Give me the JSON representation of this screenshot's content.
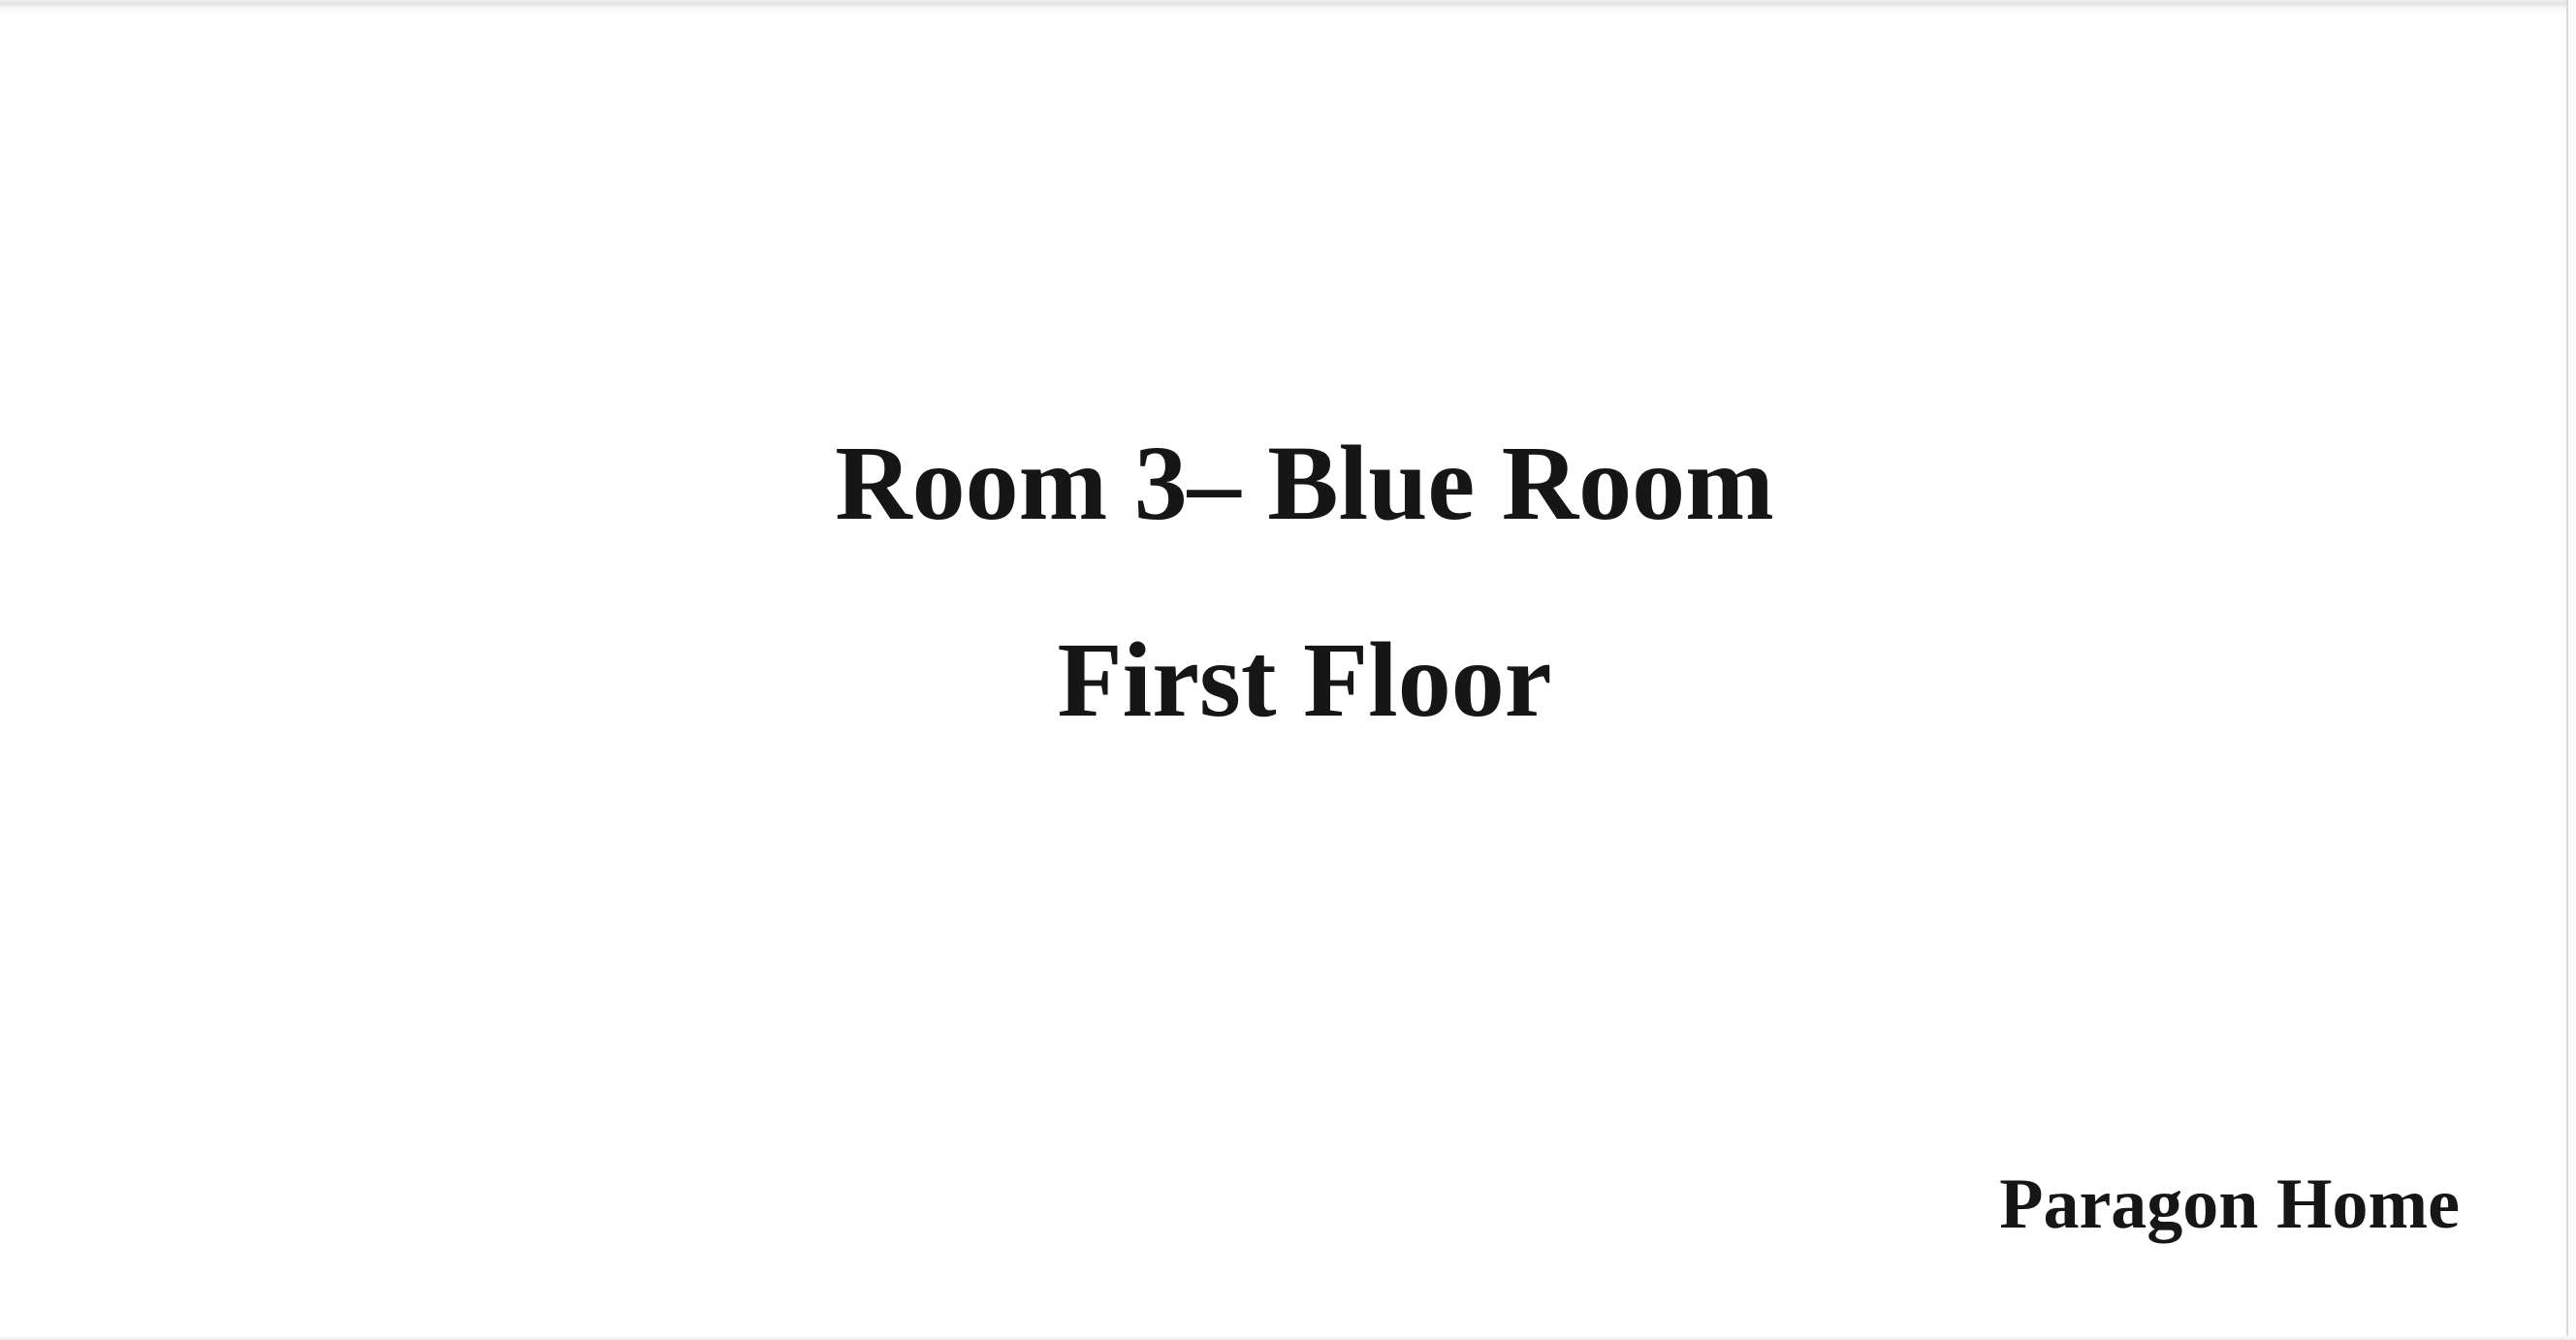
{
  "page": {
    "background_color": "#ffffff",
    "text_color": "#161616",
    "edge_color": "#d9d9d9"
  },
  "slide": {
    "heading_line1": "Room 3– Blue Room",
    "heading_line2": "First Floor",
    "footer_label": "Paragon Home"
  }
}
